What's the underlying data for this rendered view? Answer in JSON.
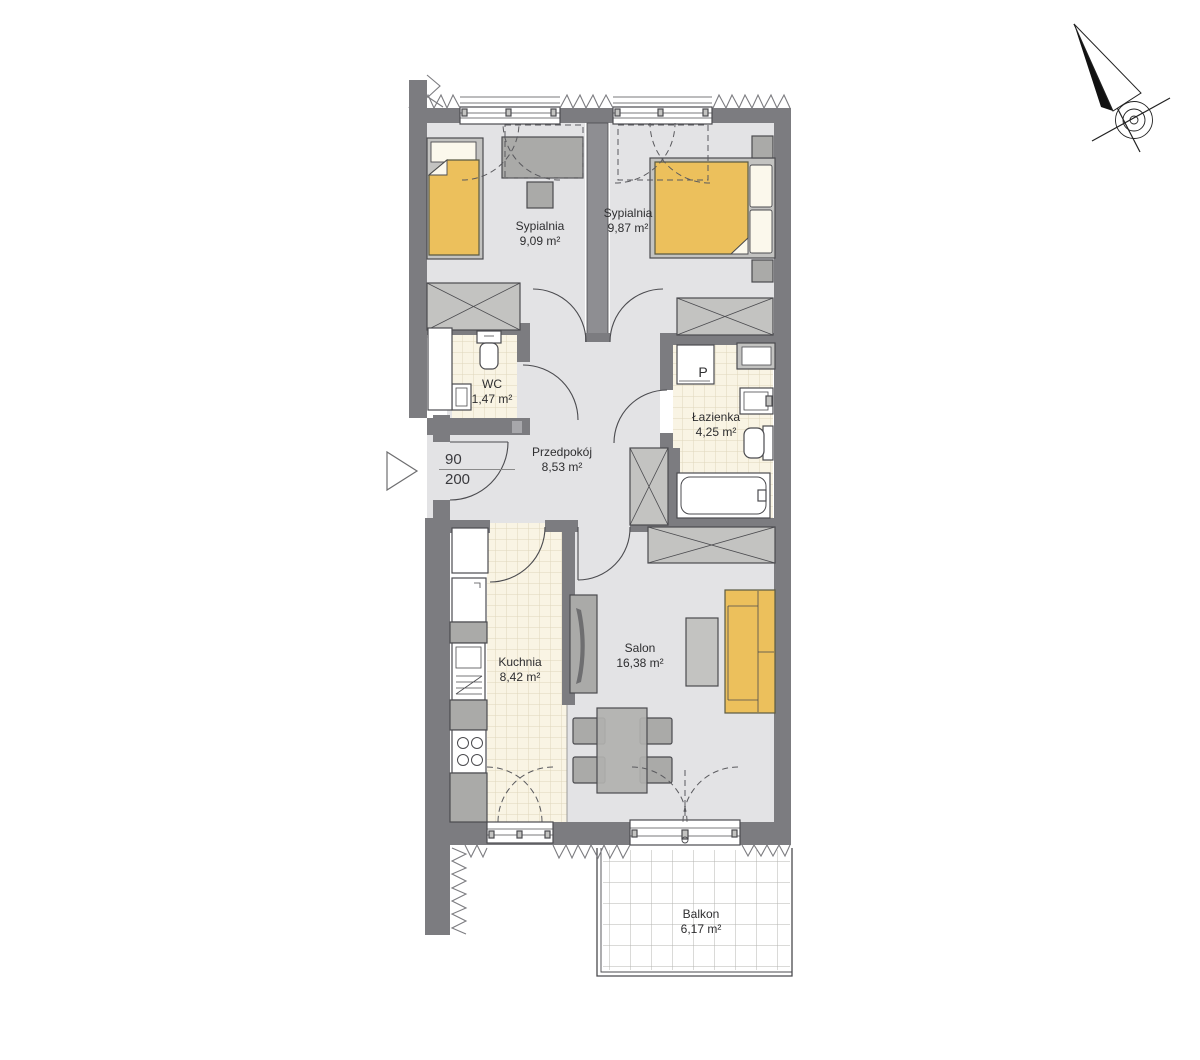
{
  "plan_title": "Apartment floor plan",
  "rooms": {
    "bedroom1": {
      "name": "Sypialnia",
      "area": "9,09 m²"
    },
    "bedroom2": {
      "name": "Sypialnia",
      "area": "9,87 m²"
    },
    "wc": {
      "name": "WC",
      "area": "1,47 m²"
    },
    "bathroom": {
      "name": "Łazienka",
      "area": "4,25 m²"
    },
    "hallway": {
      "name": "Przedpokój",
      "area": "8,53 m²"
    },
    "kitchen": {
      "name": "Kuchnia",
      "area": "8,42 m²"
    },
    "living": {
      "name": "Salon",
      "area": "16,38 m²"
    },
    "balcony": {
      "name": "Balkon",
      "area": "6,17 m²"
    }
  },
  "entry_door": {
    "width_cm": "90",
    "height_cm": "200"
  },
  "appliance_labels": {
    "washing_machine": "P"
  },
  "colors": {
    "wall": "#7c7c80",
    "wall_mid": "#8e8e92",
    "wall_light": "#a7a7ab",
    "floor": "#e3e3e5",
    "tile": "#f9f4e4",
    "tile_grid": "#ded6bc",
    "furniture": "#c3c3c1",
    "furniture_dark": "#aaaaa8",
    "accent": "#ecc05c",
    "accent_line": "#5a5a42",
    "linen": "#fbf8ec",
    "line": "#4b4b4f",
    "balcony_grid": "#b4b4b2"
  }
}
